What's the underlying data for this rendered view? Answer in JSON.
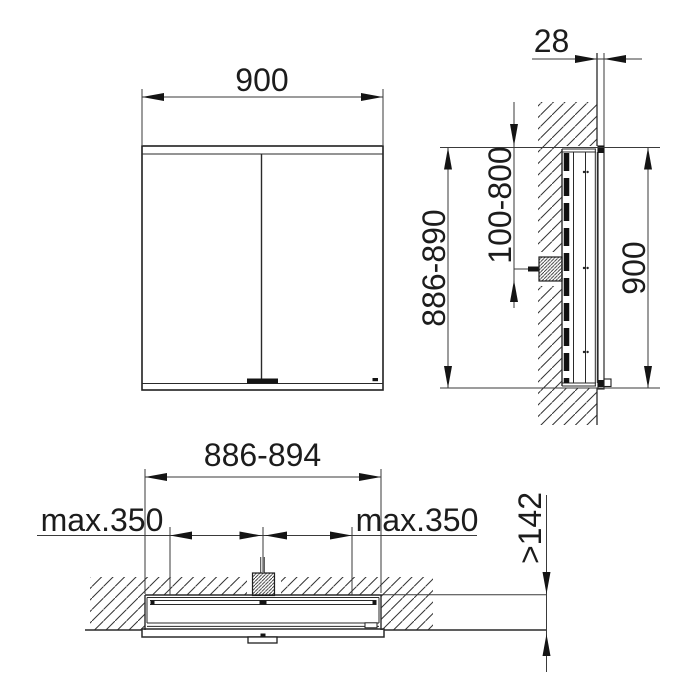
{
  "dimensions": {
    "front_width": "900",
    "side_protrusion": "28",
    "side_recess_height": "886-890",
    "side_mains_position_range": "100-800",
    "side_cabinet_height": "900",
    "plan_recess_width": "886-894",
    "plan_fixing_left": "max.350",
    "plan_fixing_right": "max.350",
    "plan_recess_depth": ">142"
  },
  "colors": {
    "line": "#1f1f1f",
    "background": "#ffffff"
  }
}
